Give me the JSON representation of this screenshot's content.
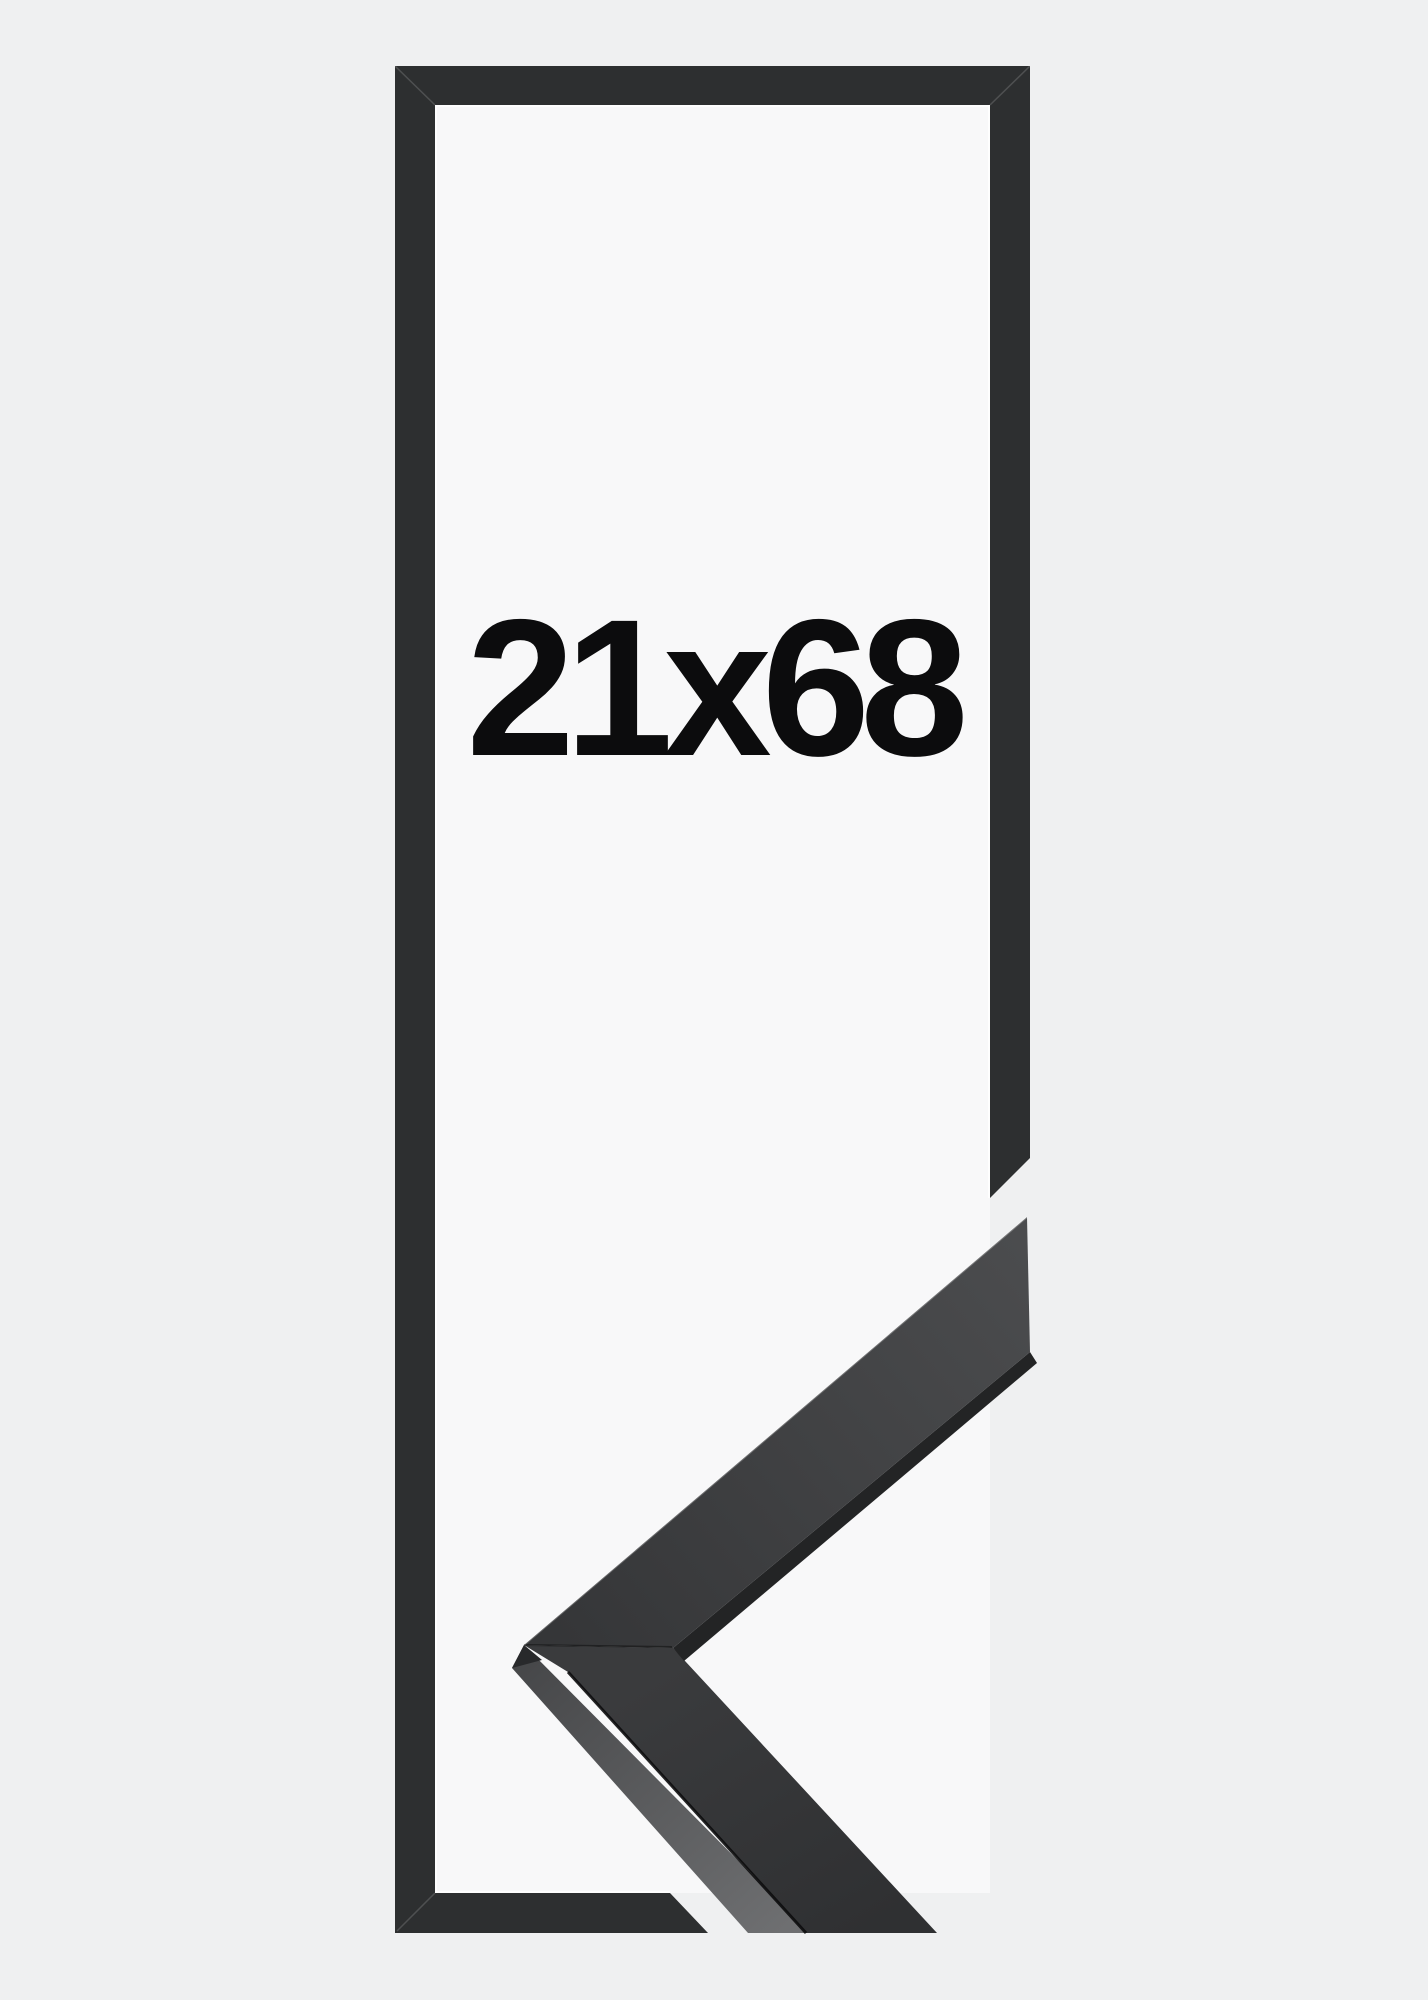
{
  "page": {
    "background": "#eff0f1"
  },
  "product_image": {
    "size_label": "21x68",
    "colors": {
      "frame": "#2d2f30",
      "opening": "#f8f8f9",
      "label": "#0c0c0d",
      "corner_top_face_light": "#4b4c4e",
      "corner_top_face_dark": "#353638",
      "corner_bottom_face_light": "#3a3b3d",
      "corner_bottom_face_dark": "#2f3032",
      "corner_side_face_light": "#6e6f71",
      "corner_side_face_dark": "#454648"
    }
  }
}
